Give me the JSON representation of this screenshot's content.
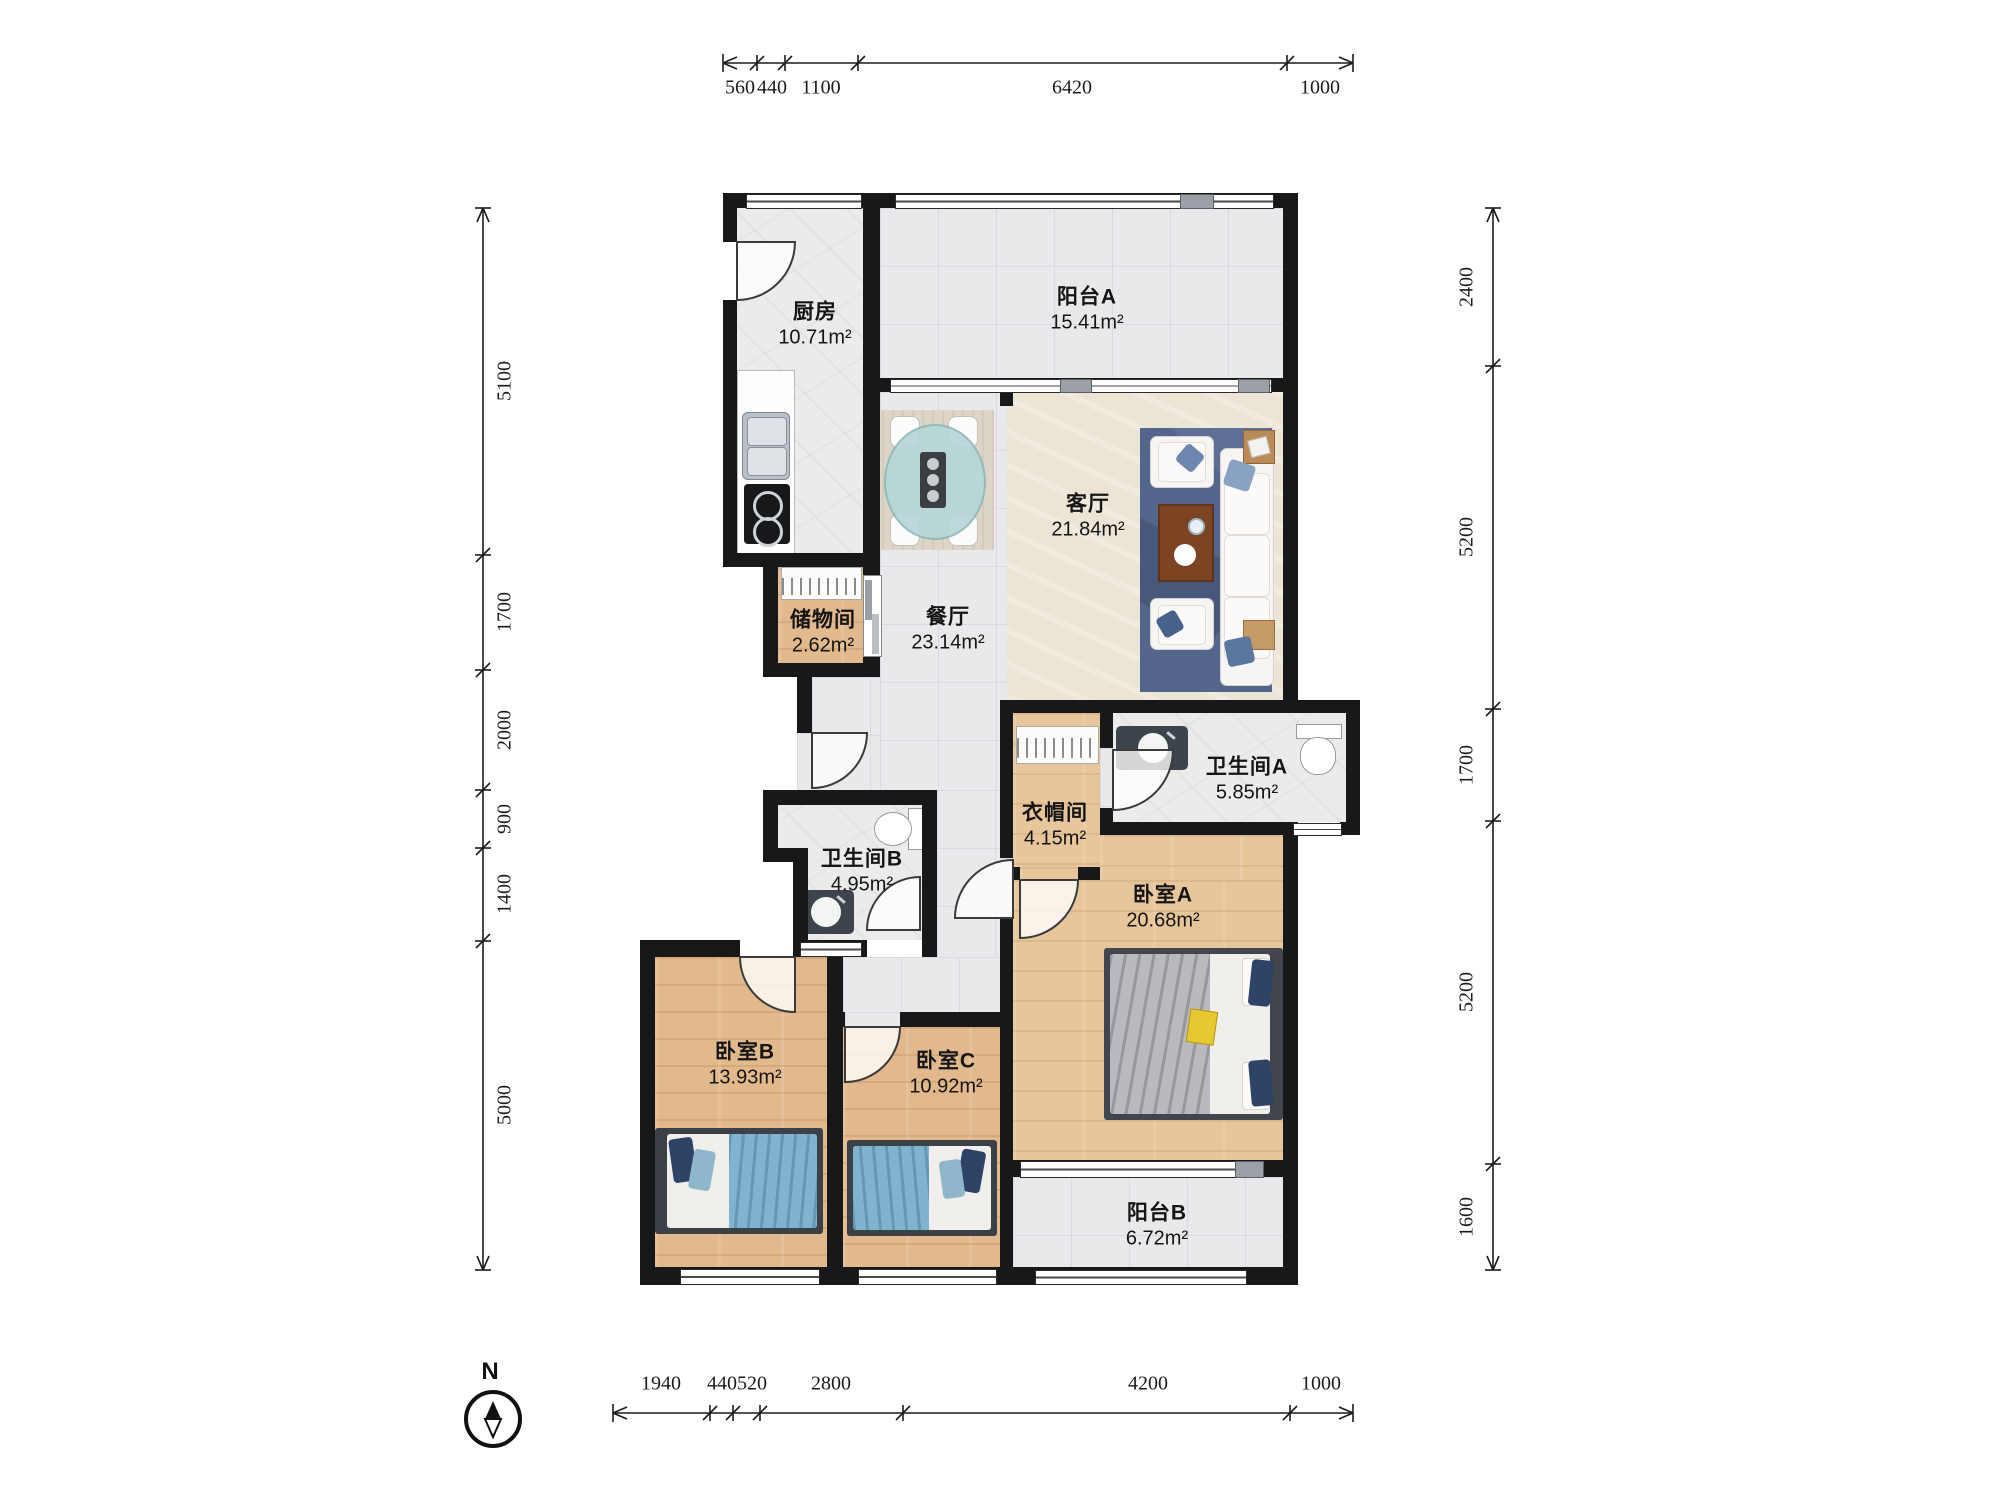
{
  "compass": {
    "label": "N"
  },
  "rooms": {
    "kitchen": {
      "name": "厨房",
      "area": "10.71m²"
    },
    "balcony_a": {
      "name": "阳台A",
      "area": "15.41m²"
    },
    "living": {
      "name": "客厅",
      "area": "21.84m²"
    },
    "dining": {
      "name": "餐厅",
      "area": "23.14m²"
    },
    "storage": {
      "name": "储物间",
      "area": "2.62m²"
    },
    "bath_b": {
      "name": "卫生间B",
      "area": "4.95m²"
    },
    "closet": {
      "name": "衣帽间",
      "area": "4.15m²"
    },
    "bath_a": {
      "name": "卫生间A",
      "area": "5.85m²"
    },
    "bed_a": {
      "name": "卧室A",
      "area": "20.68m²"
    },
    "bed_b": {
      "name": "卧室B",
      "area": "13.93m²"
    },
    "bed_c": {
      "name": "卧室C",
      "area": "10.92m²"
    },
    "balcony_b": {
      "name": "阳台B",
      "area": "6.72m²"
    }
  },
  "dimensions": {
    "top": {
      "labels": [
        "560",
        "440",
        "1100",
        "6420",
        "1000"
      ]
    },
    "bottom": {
      "labels": [
        "1940",
        "440",
        "520",
        "2800",
        "4200",
        "1000"
      ]
    },
    "left": {
      "labels": [
        "5100",
        "1700",
        "2000",
        "900",
        "1400",
        "5000"
      ]
    },
    "right": {
      "labels": [
        "2400",
        "5200",
        "1700",
        "5200",
        "1600"
      ]
    }
  },
  "colors": {
    "wall": "#17181a",
    "wood": "#e2b98c",
    "wood_light": "#e8c69c",
    "tile": "#ebebe9",
    "beige": "#ece4d4",
    "rug_blue": "#54668c",
    "blanket_blue": "#7fb3cf",
    "pillow_navy": "#2f4366",
    "counter_dark": "#3d444c",
    "table_teal": "#b7d6d8",
    "coffee_brown": "#7c4423"
  }
}
